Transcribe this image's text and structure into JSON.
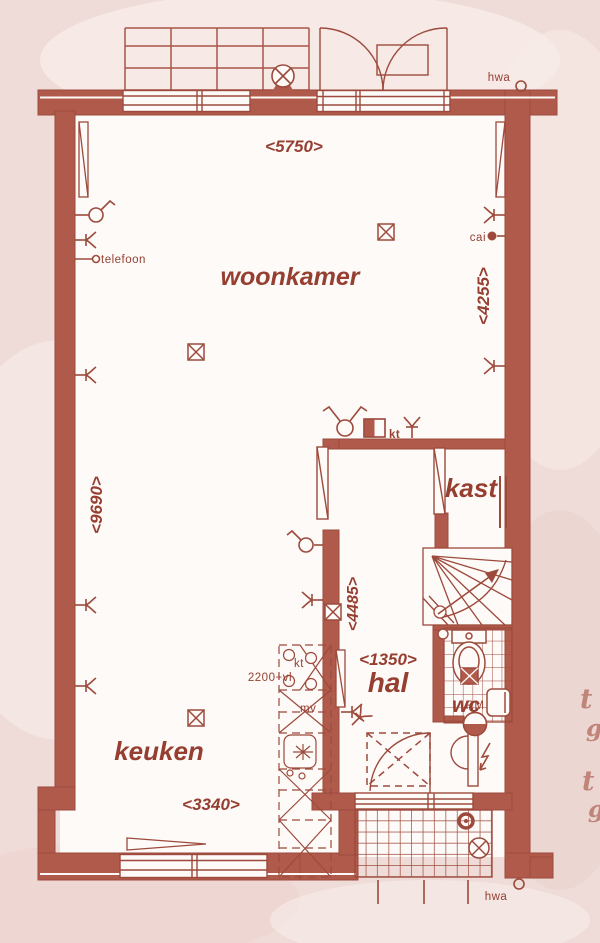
{
  "colors": {
    "wall_fill": "#b05a4b",
    "line": "#9d4a3c",
    "text": "#963f31",
    "background": "#efdcd8",
    "paper": "#fdfaf8"
  },
  "rooms": {
    "living": "woonkamer",
    "kitchen": "keuken",
    "hall": "hal",
    "closet": "kast",
    "toilet": "wc"
  },
  "dims": {
    "top_width": "<5750>",
    "right_height": "<4255>",
    "left_height": "<9690>",
    "hall_height": "<4485>",
    "hall_width": "<1350>",
    "kitchen_width": "<3340>",
    "counter_note": "2200+vl"
  },
  "labels": {
    "hwa_top": "hwa",
    "hwa_bottom": "hwa",
    "cai": "cai",
    "phone": "telefoon",
    "thermostat": "kt",
    "cooker": "kt",
    "vent": "mv",
    "smoke_detector": "RM"
  },
  "watermark": [
    "t",
    "g",
    "t",
    "g"
  ]
}
